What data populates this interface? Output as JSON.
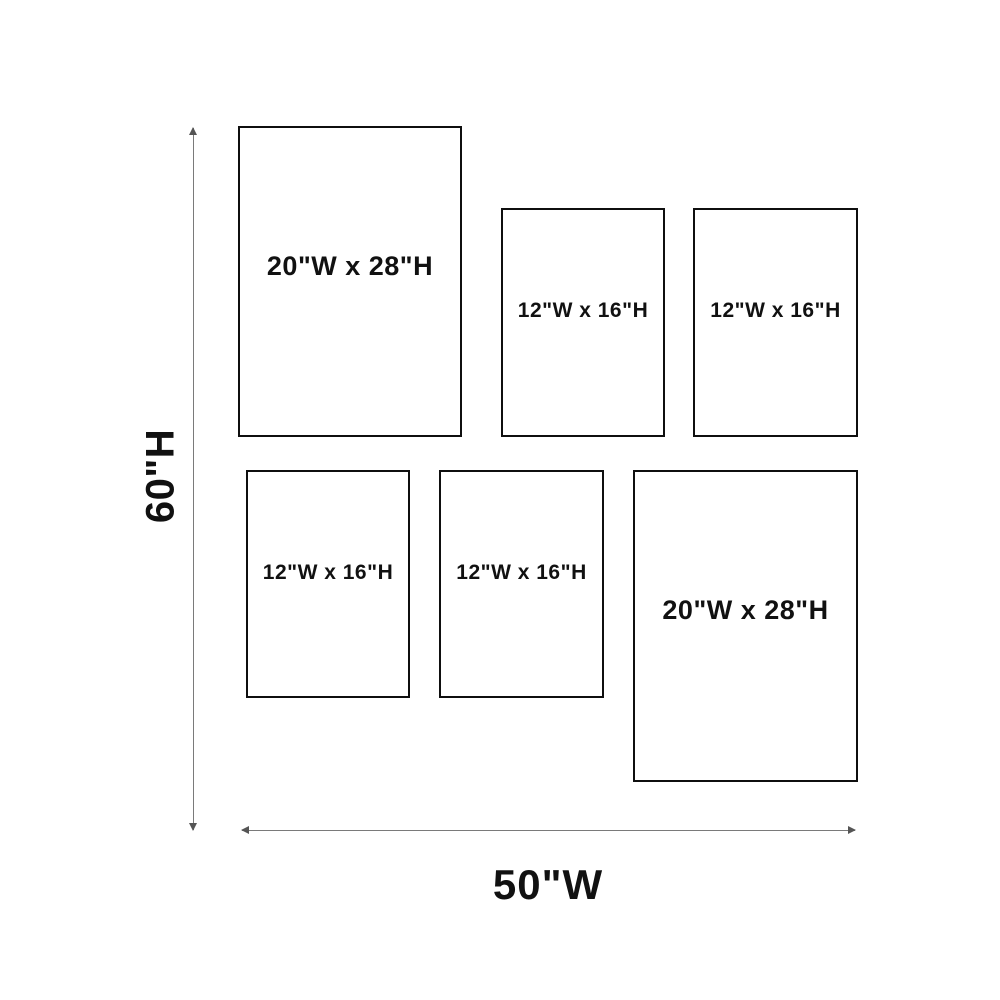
{
  "diagram": {
    "type": "gallery-wall-frame-layout"
  },
  "dimensions": {
    "height_label": "60\"H",
    "width_label": "50\"W"
  },
  "frames": [
    {
      "label": "20\"W x 28\"H",
      "size": "large",
      "position": "top-left"
    },
    {
      "label": "12\"W x 16\"H",
      "size": "small",
      "position": "top-middle"
    },
    {
      "label": "12\"W x 16\"H",
      "size": "small",
      "position": "top-right"
    },
    {
      "label": "12\"W x 16\"H",
      "size": "small",
      "position": "bottom-left"
    },
    {
      "label": "12\"W x 16\"H",
      "size": "small",
      "position": "bottom-middle"
    },
    {
      "label": "20\"W x 28\"H",
      "size": "large",
      "position": "bottom-right"
    }
  ],
  "colors": {
    "background": "#ffffff",
    "frame_border": "#0f0f0f",
    "dimension_line": "#7a7a7a",
    "text": "#111111"
  }
}
